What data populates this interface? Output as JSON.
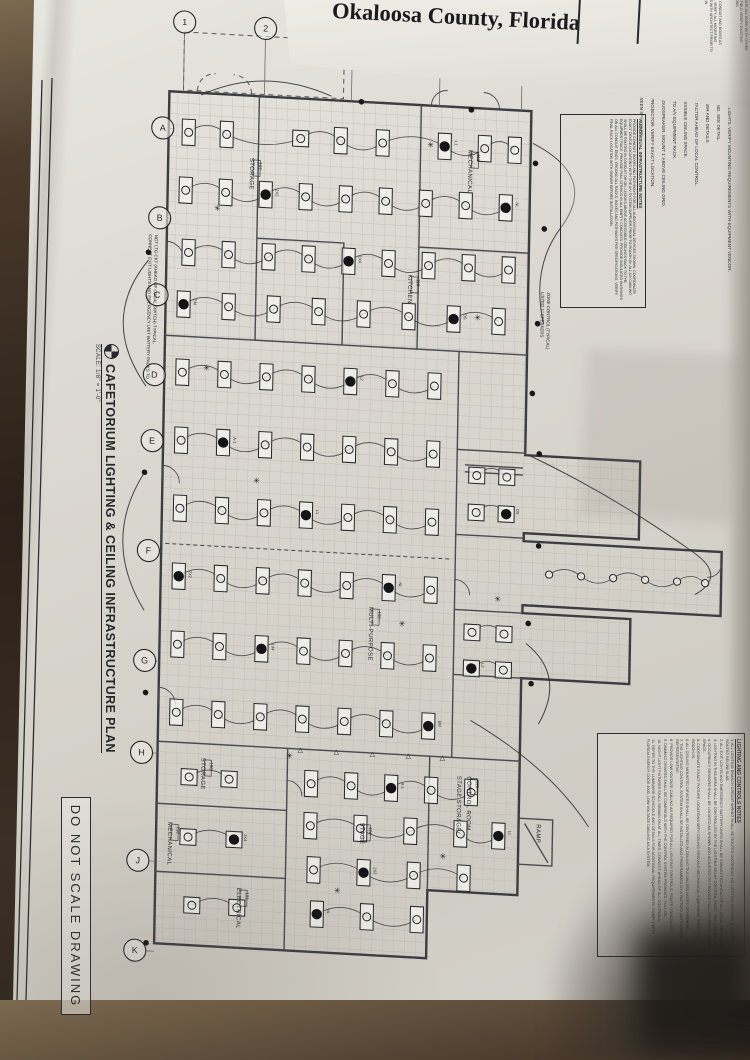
{
  "photo": {
    "header": {
      "line1_partial": "Schools",
      "line2": "Okaloosa County, Florida",
      "side_fragments": [
        "INSTALL CONDUIT AND BOXES AS SHOWN. VERIFY ALL MOUNTING HEIGHTS WITH ARCHITECT PRIOR TO ROUGH-IN.",
        "COORDINATE ALL WORK WITH OTHER TRADES. FIELD VERIFY EXISTING CONDITIONS.",
        "12. REFER TO SCHEDULES AND DETAILS FOR ADDITIONAL REQUIREMENTS."
      ]
    },
    "sheet": {
      "title": "CAFETORIUM LIGHTING & CEILING INFRASTRUCTURE PLAN",
      "title_marker_icon": "north-detail-marker",
      "scale_label": "SCALE: 1/8\" = 1'-0\"",
      "do_not_scale": "DO NOT SCALE DRAWING",
      "grid_columns": [
        "1",
        "2",
        "3",
        "4",
        "5"
      ],
      "grid_rows": [
        "A",
        "B",
        "C",
        "D",
        "E",
        "F",
        "G",
        "H",
        "J",
        "K"
      ],
      "plan_notes": [
        {
          "id": "exit-note",
          "text": "CONNECT EXIT LIGHTS AND EMERGENCY UNIT BATTERY PACKS TO NGT LTG CKT (AHEAD OF LOCAL SWITCH) TYPICAL.",
          "x": 150,
          "y": 232
        },
        {
          "id": "speaker-zone-note",
          "text": "LISTED 1\" SPEAKERS ZONE CONTROL (TYPICAL)",
          "x": 543,
          "y": 268
        }
      ],
      "rooms": [
        {
          "name": "STORAGE",
          "num": "107",
          "x": 250,
          "y": 150
        },
        {
          "name": "KITCHEN",
          "num": "110",
          "x": 410,
          "y": 258
        },
        {
          "name": "MECHANICAL",
          "num": "113",
          "x": 468,
          "y": 130
        },
        {
          "name": "MULTI-PURPOSE",
          "num": "102",
          "x": 377,
          "y": 592
        },
        {
          "name": "STAGE",
          "num": "124",
          "x": 372,
          "y": 808
        },
        {
          "name": "STAGE STORAGE/",
          "num": "",
          "x": 468,
          "y": 756
        },
        {
          "name": "CONTROL ROOM",
          "num": "126",
          "x": 478,
          "y": 756
        },
        {
          "name": "STORAGE",
          "num": "130",
          "x": 212,
          "y": 752
        },
        {
          "name": "MECHANICAL",
          "num": "132",
          "x": 180,
          "y": 818
        },
        {
          "name": "ELECTRICAL",
          "num": "131",
          "x": 250,
          "y": 880
        },
        {
          "name": "RAMP",
          "num": "",
          "x": 548,
          "y": 800
        }
      ],
      "fixture_tags": [
        "L1",
        "2X2",
        "NL",
        "1X4",
        "EM",
        "OS",
        "L2",
        "A-1"
      ],
      "keynotes": {
        "title": "KEYNOTES:",
        "items": [
          "JUNCTION BOX FOR COOLER AND FREEZER LIGHTS. VERIFY MOUNTING REQUIREMENTS WITH EQUIPMENT VENDOR.",
          "DIMMER BANK TO CONTROL HOUSE LIGHTING. SEE DETAIL.",
          "LIGHTING RELAY CONTROL PANEL. SEE RISER AND DETAILS.",
          "ROUTE CIRCUIT THROUGH LIGHTING CONTACTOR AHEAD OF LOCAL CONTROL.",
          "3/4\" C. WITH PULL WIRE STUBBED TO ACCESSIBLE CEILING SPACE.",
          "INSTALL J-HOOKS 4'-0\" ON CENTER BACK TO A/V EQUIPMENT RACK.",
          "JUNCTION BOX FOR CEILING MOUNTED LOUDSPEAKER. MOUNT 1' ABOVE CEILING GRID.",
          "JUNCTION BOX FOR CEILING MOUNTED PROJECTOR. VERIFY EXACT LOCATION.",
          "INSTALL J-HOOKS 4'-0\" ON CENTER BETWEEN SPEAKERS."
        ]
      },
      "av_notes": {
        "title": "AUDIO/VISUAL INFRASTRUCTURE NOTES",
        "body": "PROVIDE CONDUIT, BOXES AND PATHWAYS FOR ALL AUDIO/VISUAL DEVICES SHOWN. COORDINATE EXACT DEVICE LOCATIONS WITH THE A/V SYSTEM SUPPLIER PRIOR TO ROUGH-IN. ALL A/V CABLING SHALL BE ROUTED IN CONDUIT OR ON J-HOOKS ABOVE ACCESSIBLE CEILINGS BACK TO THE EQUIPMENT RACK. PROVIDE PULL STRINGS IN ALL EMPTY CONDUITS. PROVIDE INSULATED BUSHINGS ON ALL CONDUIT ENDS. GROUND ALL RACKS, BOXES AND PATHWAYS PER SPECIFICATIONS. VERIFY FINAL RACK LOCATION WITH OWNER BEFORE INSTALLATION."
      },
      "lighting_notes": {
        "title": "LIGHTING AND CONTROLS NOTES",
        "items": [
          "ALL LIGHTING BRANCH CIRCUIT WIRING SHALL BE ROUTED OVERHEAD. NO LIGHTING CIRCUITS SHALL BE ROUTED BELOW SLAB.",
          "ALL EXIT LIGHTS AND EMERGENCY BATTERY UNITS SHALL BE CONNECTED AHEAD OF ALL LOCAL SWITCHING.",
          "LIGHTING IN THIS AREA SHALL BE CONTROLLED BY THE LIGHTING RELAY CONTROL PANEL. SEE DETAILS.",
          "OCCUPANCY SENSORS SHALL BE LOCATED AS SHOWN AND ADJUSTED TO PROVIDE FULL COVERAGE IN EACH SPACE.",
          "COORDINATE EXACT FIXTURE LOCATIONS WITH CEILING GRID AND MECHANICAL EQUIPMENT PRIOR TO ROUGH-IN.",
          "ALL CEILING MOUNTED DEVICES SHALL BE CENTERED IN CEILING TILE UNLESS NOTED OTHERWISE.",
          "THE LIGHTING CONTROL SYSTEM SHALL BE INSTALLED AND PROGRAMMED BY A FACTORY AUTHORIZED REPRESENTATIVE.",
          "PROVIDE LOW VOLTAGE CABLING AS REQUIRED FOR ALL LIGHTING CONTROLS. ROUTE CONCEALED.",
          "DIMMING DRIVERS SHALL BE COMPATIBLE WITH THE CONTROL SYSTEM PROVIDED. FULL ON.",
          "NIGHT LIGHT FIXTURES SHALL REMAIN ON AT ALL TIMES. CONNECT AHEAD OF ALL CONTROLS.",
          "REFER TO THE LUMINAIRE SCHEDULE AND DETAILS FOR ADDITIONAL REQUIREMENTS. COMPLY WITH FLORIDA ENERGY CODE 2020, LOW VOLTAGE CABLING AS A SYSTEM."
        ]
      }
    }
  }
}
